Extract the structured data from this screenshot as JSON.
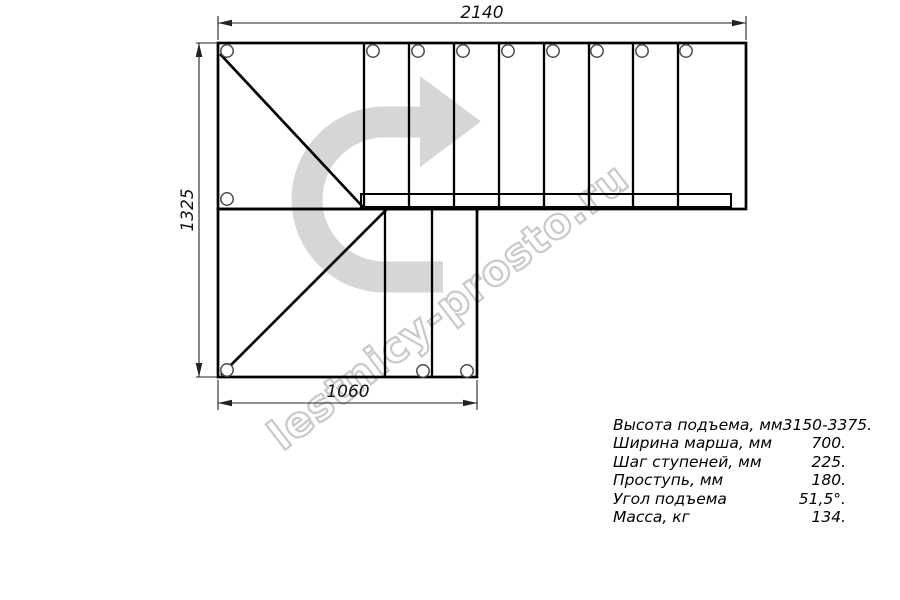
{
  "drawing": {
    "title": "stair-plan-top-view",
    "dimensions": {
      "top_width_mm": "2140",
      "left_height_mm": "1325",
      "bottom_width_mm": "1060"
    },
    "watermark": {
      "text": "lestnicy-prosto.ru",
      "text_outline_color": "#c9c9c9",
      "arrow_color": "#d6d6d6"
    },
    "line_color": "#000000",
    "steps_top_flight": 8,
    "steps_bottom_flight": 2
  },
  "specs": {
    "rows": [
      {
        "label": "Высота подъема, мм",
        "value": "3150-3375."
      },
      {
        "label": "Ширина марша, мм",
        "value": "700."
      },
      {
        "label": "Шаг ступеней, мм",
        "value": "225."
      },
      {
        "label": "Проступь, мм",
        "value": "180."
      },
      {
        "label": "Угол подъема",
        "value": "51,5°."
      },
      {
        "label": "Масса, кг",
        "value": "134."
      }
    ]
  }
}
